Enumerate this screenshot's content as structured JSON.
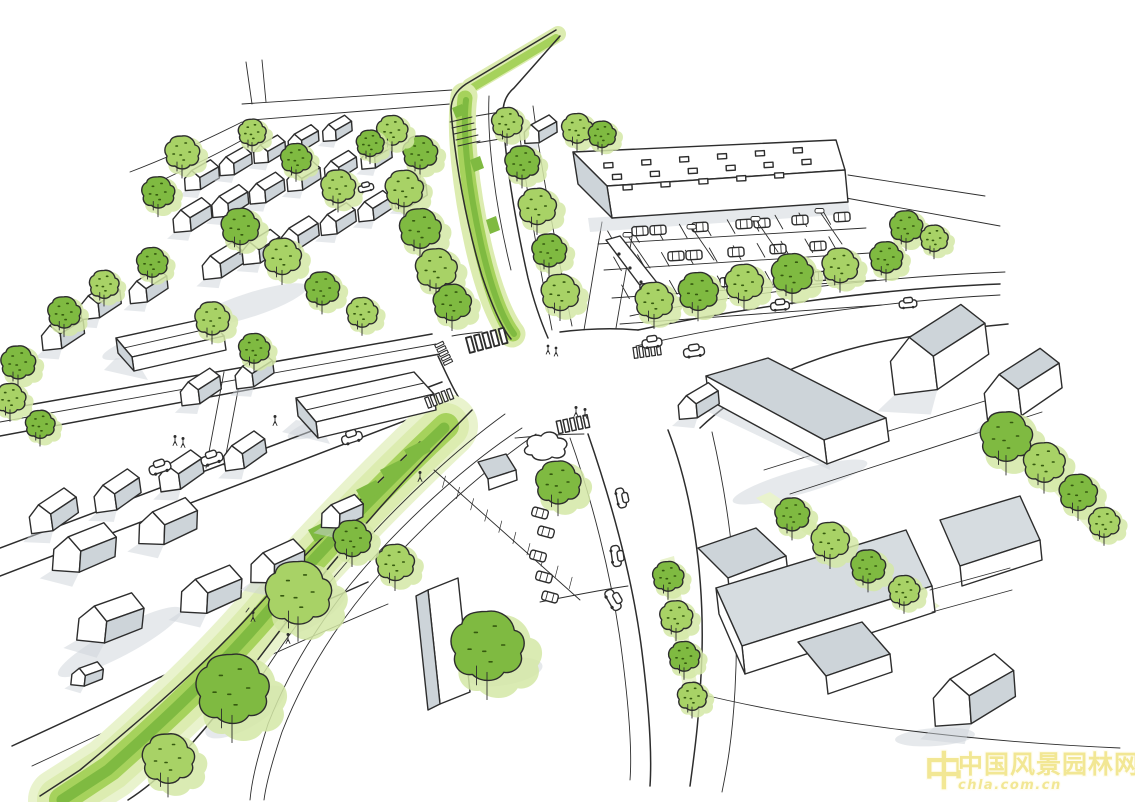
{
  "watermark": {
    "logo_glyph": "中",
    "line1": "中国风景园林网",
    "line2": "chla.com.cn"
  },
  "palette": {
    "paper": "#ffffff",
    "ink": "#2d2d2d",
    "shadow_gray": "#cdd4d9",
    "tree_green": "#a8d266",
    "tree_green_dark": "#7fba41",
    "tree_halo": "#d3e8a6",
    "greenway_light": "#dcecb0",
    "greenway_bright": "#a6d25c",
    "greenway_pale": "#e9f3cd",
    "watermark_yellow": "#f1e58c"
  }
}
